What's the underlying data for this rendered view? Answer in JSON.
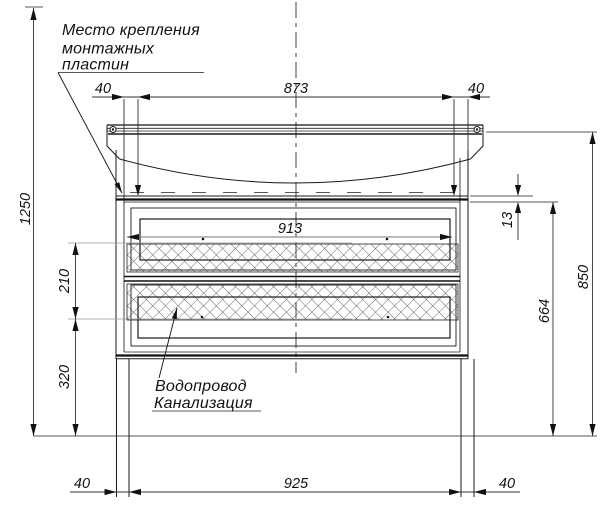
{
  "notes": {
    "mounting_plates": {
      "line1": "Место крепления",
      "line2": "монтажных",
      "line3": "пластин"
    },
    "plumbing": {
      "line1": "Водопровод",
      "line2": "Канализация"
    }
  },
  "dimensions": {
    "top_left_offset": "40",
    "top_span": "873",
    "top_right_offset": "40",
    "overall_height": "1250",
    "inner_width": "913",
    "rail_thickness": "13",
    "hatch_zone_height": "210",
    "plumbing_zone_height": "320",
    "cabinet_height": "664",
    "worktop_height": "850",
    "bottom_left_offset": "40",
    "bottom_span": "925",
    "bottom_right_offset": "40"
  },
  "colors": {
    "line": "#1a1a1a",
    "dimension": "#333333",
    "extension": "#999999",
    "hatch": "#333333",
    "background": "#ffffff"
  }
}
